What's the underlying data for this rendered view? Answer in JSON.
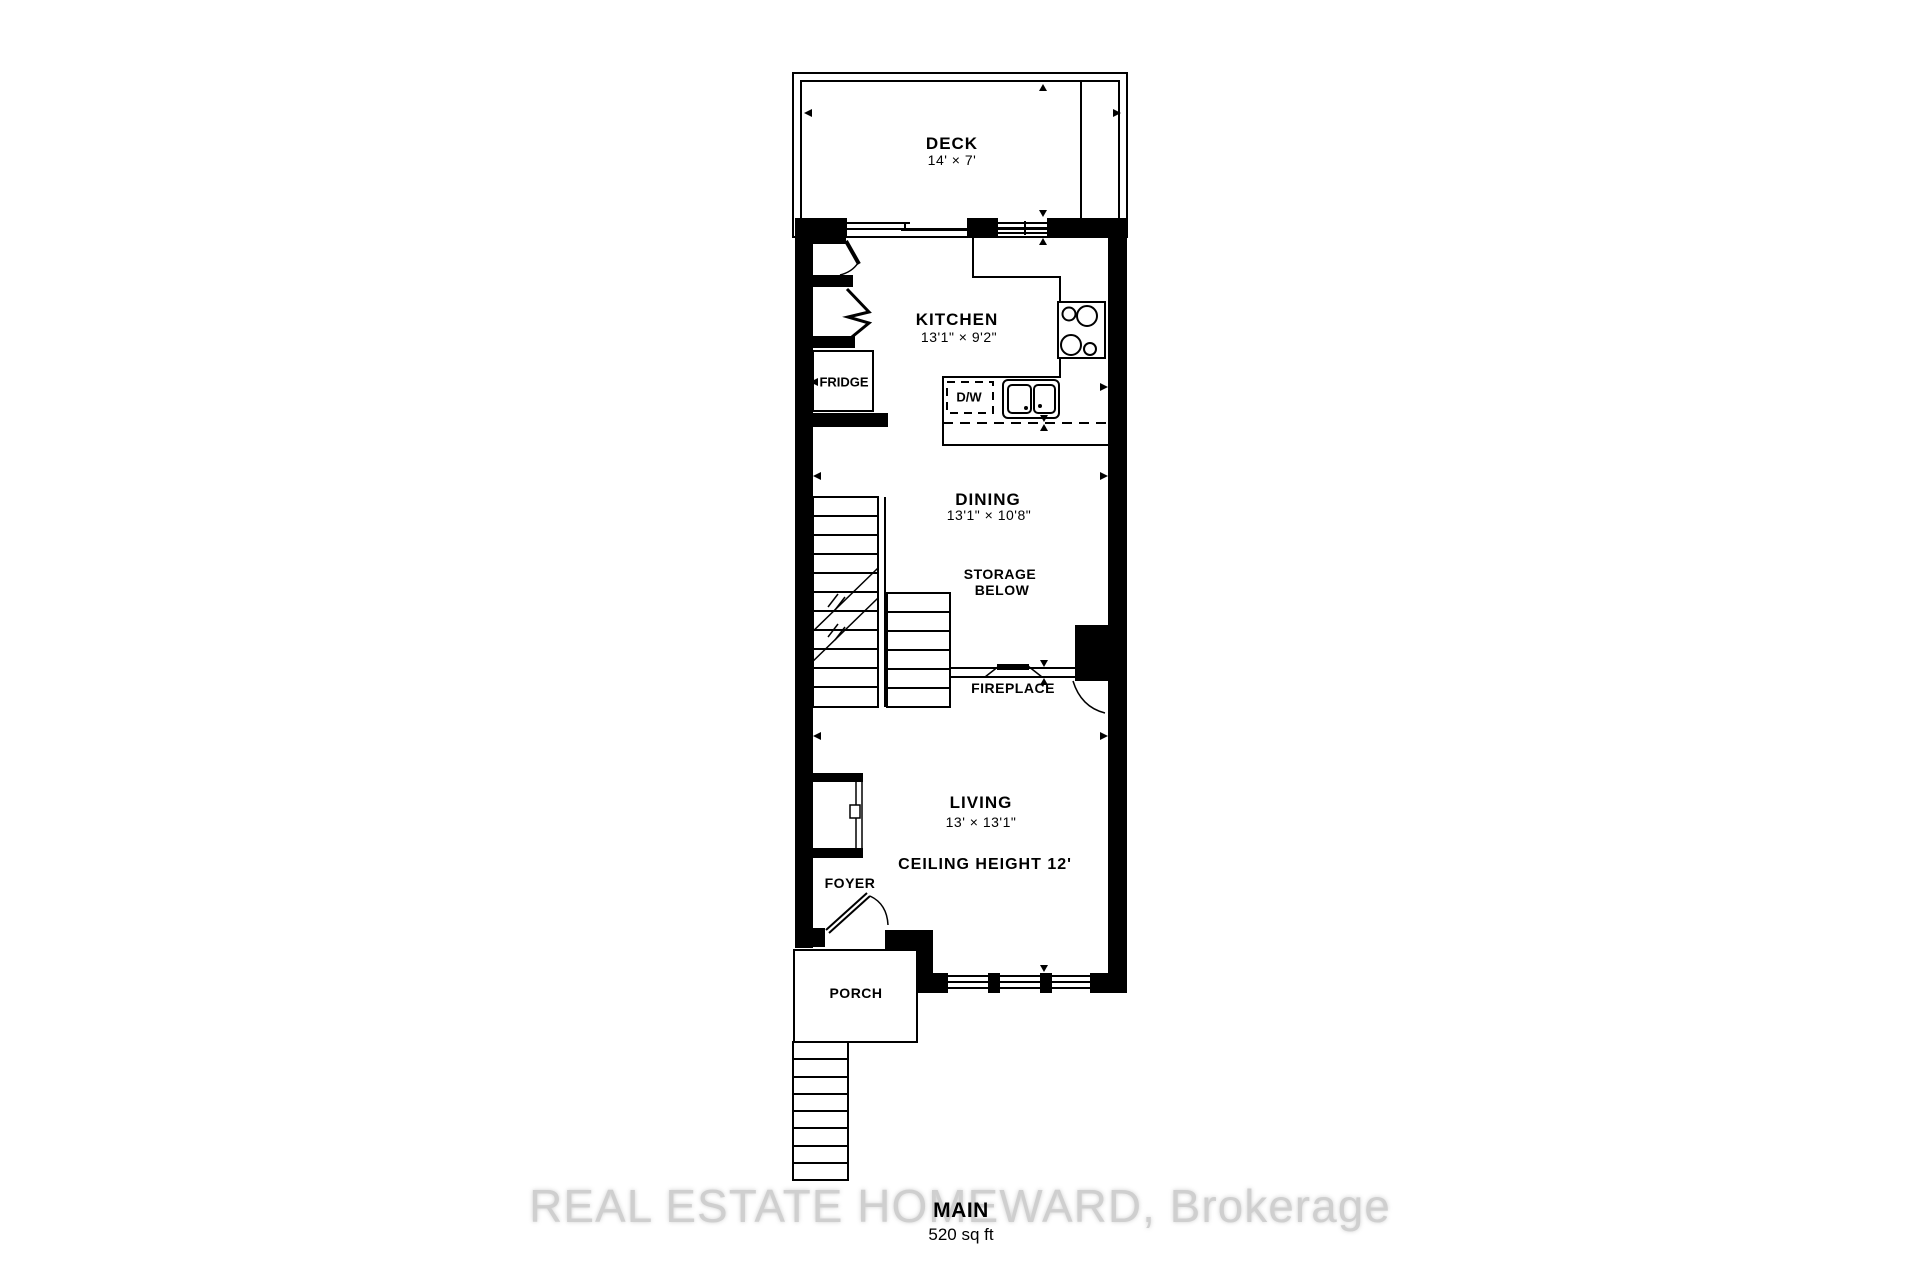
{
  "floor": {
    "name": "MAIN",
    "area": "520 sq ft"
  },
  "watermark": "REAL ESTATE HOMEWARD, Brokerage",
  "rooms": {
    "deck": {
      "name": "DECK",
      "dims": "14' × 7'"
    },
    "kitchen": {
      "name": "KITCHEN",
      "dims": "13'1\" × 9'2\""
    },
    "dining": {
      "name": "DINING",
      "dims": "13'1\" × 10'8\""
    },
    "living": {
      "name": "LIVING",
      "dims": "13' × 13'1\"",
      "ceiling_note": "CEILING HEIGHT 12'"
    },
    "foyer": {
      "name": "FOYER"
    },
    "porch": {
      "name": "PORCH"
    }
  },
  "fixtures": {
    "fridge": "FRIDGE",
    "dishwasher": "D/W",
    "storage_line1": "STORAGE",
    "storage_line2": "BELOW",
    "fireplace": "FIREPLACE"
  },
  "colors": {
    "wall": "#000000",
    "background": "#ffffff",
    "watermark": "#cfcfcf"
  }
}
